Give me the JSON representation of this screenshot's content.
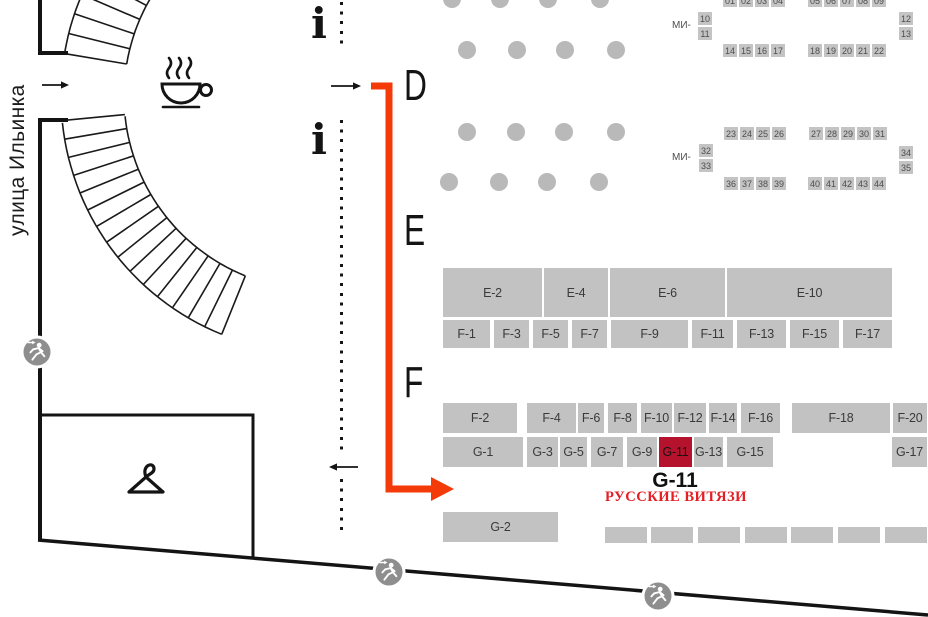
{
  "street_label": "улица Ильинка",
  "zones": {
    "d": "D",
    "e": "E",
    "f": "F"
  },
  "info_glyph": "i",
  "icons": {
    "coffee": "coffee-cup",
    "info": "information-i",
    "exit": "running-person-exit",
    "cloakroom": "clothes-hanger",
    "route": "red-route-arrow"
  },
  "colors": {
    "booth_gray": "#c2c2c2",
    "booth_text": "#3a3a3a",
    "pillar_gray": "#b9b9b9",
    "exit_gray": "#8e8e8e",
    "route_red": "#f43a08",
    "highlight_booth_red": "#b5122d",
    "brand_text_red": "#e31e24",
    "wall_black": "#141414",
    "stand_square_gray": "#c4c4c4"
  },
  "highlight_caption": {
    "id": "G-11",
    "company": "РУССКИЕ ВИТЯЗИ"
  },
  "booth_rows": [
    {
      "name": "row-e",
      "y": 268,
      "h": 49,
      "booths": [
        {
          "id": "E-2",
          "x": 443,
          "w": 99
        },
        {
          "id": "E-4",
          "x": 544,
          "w": 64
        },
        {
          "id": "E-6",
          "x": 610,
          "w": 115
        },
        {
          "id": "E-10",
          "x": 727,
          "w": 165
        }
      ]
    },
    {
      "name": "row-f-odd",
      "y": 320,
      "h": 28,
      "booths": [
        {
          "id": "F-1",
          "x": 443,
          "w": 47
        },
        {
          "id": "F-3",
          "x": 494,
          "w": 35
        },
        {
          "id": "F-5",
          "x": 533,
          "w": 35
        },
        {
          "id": "F-7",
          "x": 572,
          "w": 35
        },
        {
          "id": "F-9",
          "x": 611,
          "w": 77
        },
        {
          "id": "F-11",
          "x": 692,
          "w": 41
        },
        {
          "id": "F-13",
          "x": 737,
          "w": 49
        },
        {
          "id": "F-15",
          "x": 790,
          "w": 49
        },
        {
          "id": "F-17",
          "x": 843,
          "w": 49
        }
      ]
    },
    {
      "name": "row-f-even",
      "y": 403,
      "h": 30,
      "booths": [
        {
          "id": "F-2",
          "x": 443,
          "w": 74
        },
        {
          "id": "F-4",
          "x": 527,
          "w": 49
        },
        {
          "id": "F-6",
          "x": 578,
          "w": 26
        },
        {
          "id": "F-8",
          "x": 608,
          "w": 29
        },
        {
          "id": "F-10",
          "x": 641,
          "w": 31
        },
        {
          "id": "F-12",
          "x": 674,
          "w": 32
        },
        {
          "id": "F-14",
          "x": 709,
          "w": 28
        },
        {
          "id": "F-16",
          "x": 741,
          "w": 39
        },
        {
          "id": "F-18",
          "x": 792,
          "w": 98
        },
        {
          "id": "F-20",
          "x": 893,
          "w": 34
        }
      ]
    },
    {
      "name": "row-g",
      "y": 437,
      "h": 30,
      "booths": [
        {
          "id": "G-1",
          "x": 443,
          "w": 80
        },
        {
          "id": "G-3",
          "x": 527,
          "w": 31
        },
        {
          "id": "G-5",
          "x": 560,
          "w": 27
        },
        {
          "id": "G-7",
          "x": 591,
          "w": 32
        },
        {
          "id": "G-9",
          "x": 627,
          "w": 30
        },
        {
          "id": "G-11",
          "x": 659,
          "w": 33,
          "hl": true
        },
        {
          "id": "G-13",
          "x": 694,
          "w": 29
        },
        {
          "id": "G-15",
          "x": 727,
          "w": 46
        },
        {
          "id": "G-17",
          "x": 892,
          "w": 35
        }
      ]
    },
    {
      "name": "row-g2",
      "y": 512,
      "h": 30,
      "booths": [
        {
          "id": "G-2",
          "x": 443,
          "w": 115
        }
      ]
    },
    {
      "name": "row-bottom-unlabeled",
      "y": 527,
      "h": 16,
      "booths": [
        {
          "id": "",
          "x": 605,
          "w": 42
        },
        {
          "id": "",
          "x": 651,
          "w": 42
        },
        {
          "id": "",
          "x": 698,
          "w": 42
        },
        {
          "id": "",
          "x": 745,
          "w": 42
        },
        {
          "id": "",
          "x": 791,
          "w": 42
        },
        {
          "id": "",
          "x": 838,
          "w": 42
        },
        {
          "id": "",
          "x": 885,
          "w": 42
        }
      ]
    }
  ],
  "mi_clusters": [
    {
      "label": "МИ-",
      "label_pos": {
        "x": 672,
        "y": 20
      },
      "rows": [
        {
          "y": -6,
          "groups": [
            {
              "x": 723,
              "nums": [
                "01",
                "02",
                "03",
                "04"
              ]
            },
            {
              "x": 808,
              "nums": [
                "05",
                "06",
                "07",
                "08",
                "09"
              ]
            }
          ]
        },
        {
          "y": 44,
          "groups": [
            {
              "x": 723,
              "nums": [
                "14",
                "15",
                "16",
                "17"
              ]
            },
            {
              "x": 808,
              "nums": [
                "18",
                "19",
                "20",
                "21",
                "22"
              ]
            }
          ]
        }
      ],
      "left_stack": {
        "x": 698,
        "y": 12,
        "nums": [
          "10",
          "11"
        ]
      },
      "right_stack": {
        "x": 899,
        "y": 12,
        "nums": [
          "12",
          "13"
        ]
      }
    },
    {
      "label": "МИ-",
      "label_pos": {
        "x": 672,
        "y": 152
      },
      "rows": [
        {
          "y": 127,
          "groups": [
            {
              "x": 724,
              "nums": [
                "23",
                "24",
                "25",
                "26"
              ]
            },
            {
              "x": 809,
              "nums": [
                "27",
                "28",
                "29",
                "30",
                "31"
              ]
            }
          ]
        },
        {
          "y": 177,
          "groups": [
            {
              "x": 724,
              "nums": [
                "36",
                "37",
                "38",
                "39"
              ]
            },
            {
              "x": 808,
              "nums": [
                "40",
                "41",
                "42",
                "43",
                "44"
              ]
            }
          ]
        }
      ],
      "left_stack": {
        "x": 699,
        "y": 144,
        "nums": [
          "32",
          "33"
        ]
      },
      "right_stack": {
        "x": 899,
        "y": 146,
        "nums": [
          "34",
          "35"
        ]
      }
    }
  ],
  "pillars": {
    "r": 9,
    "rows": [
      {
        "y": -1,
        "xs": [
          452,
          500,
          548,
          600
        ]
      },
      {
        "y": 50,
        "xs": [
          467,
          517,
          565,
          616
        ]
      },
      {
        "y": 132,
        "xs": [
          467,
          516,
          564,
          616
        ]
      },
      {
        "y": 182,
        "xs": [
          449,
          499,
          547,
          599
        ]
      }
    ]
  }
}
